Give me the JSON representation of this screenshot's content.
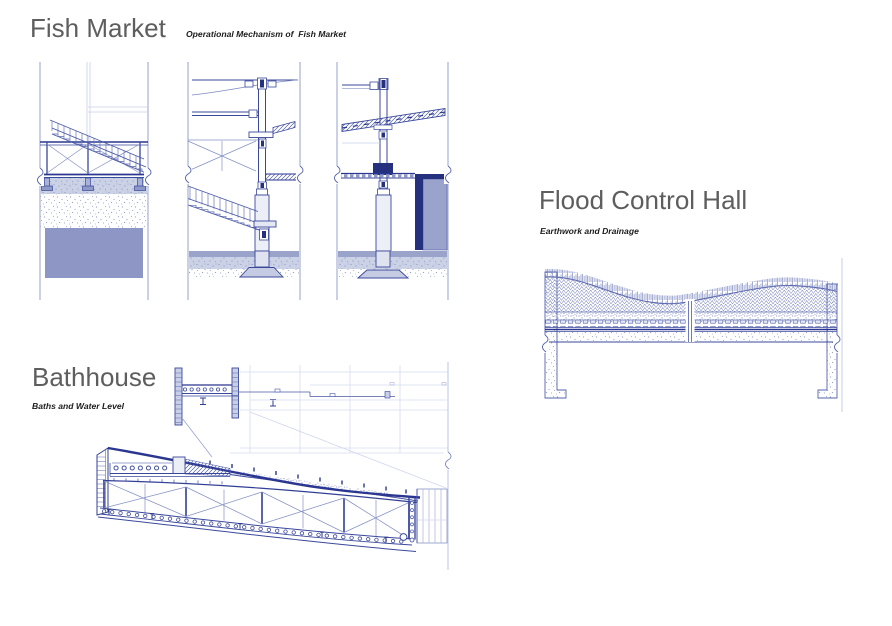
{
  "page": {
    "width": 892,
    "height": 626,
    "background": "#ffffff"
  },
  "palette": {
    "ink": "#3a489c",
    "ink_strong": "#2a368f",
    "ink_faint": "#c9d0e8",
    "navy_fill": "#25317f",
    "water_fill": "#8d96c4",
    "ground_band_fill": "#9aa3c9",
    "light_band_fill": "#ccd2e6",
    "casing_fill": "#edeff7",
    "title_color": "#5e5e5e",
    "subtitle_color": "#1c1c1c"
  },
  "sections": {
    "fish_market": {
      "title": "Fish Market",
      "subtitle": "Operational Mechanism of  Fish Market"
    },
    "bathhouse": {
      "title": "Bathhouse",
      "subtitle": "Baths and Water Level"
    },
    "flood_control_hall": {
      "title": "Flood Control Hall",
      "subtitle": "Earthwork and Drainage"
    }
  }
}
